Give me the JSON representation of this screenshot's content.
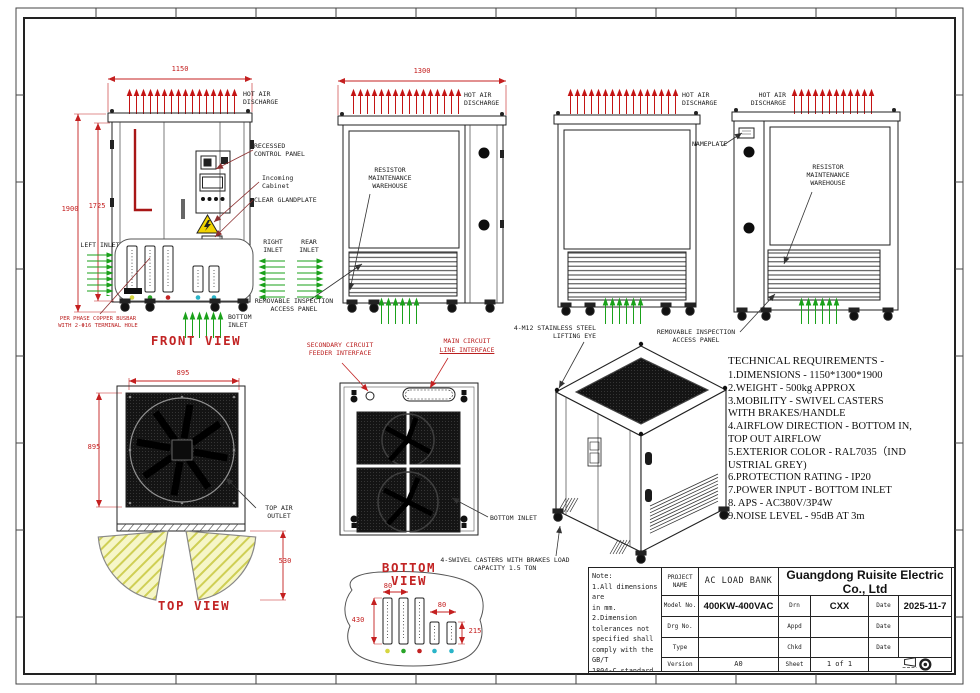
{
  "colors": {
    "dim_red": "#c42020",
    "arrow_red": "#c41414",
    "arrow_green": "#1aa11a",
    "leader_maroon": "#8b2f2f",
    "warning_yellow": "#f2d400",
    "exterior_color_code": "RAL7035"
  },
  "views": {
    "front": "FRONT VIEW",
    "top": "TOP VIEW",
    "bottom": "BOTTOM VIEW"
  },
  "dims": {
    "front_width": "1150",
    "side_width": "1300",
    "total_height": "1900",
    "body_height": "1725",
    "top_width": "895",
    "top_depth": "895",
    "door_swing": "530",
    "busbar_pitch": "80",
    "busbar_main_len": "430",
    "busbar_short_len": "215"
  },
  "labels": {
    "hot_air": "HOT AIR DISCHARGE",
    "recessed": "RECESSED CONTROL PANEL",
    "incoming": "Incoming Cabinet",
    "glandplate": "CLEAR GLANDPLATE",
    "left_inlet": "LEFT INLET",
    "right_inlet": "RIGHT INLET",
    "rear_inlet": "REAR INLET",
    "bottom_inlet": "BOTTOM INLET",
    "removable_panel": "REMOVABLE INSPECTION ACCESS PANEL",
    "busbar_note": "PER PHASE COPPER BUSBAR\nWITH 2-Φ16 TERMINAL HOLE",
    "resistor_warehouse": "RESISTOR MAINTENANCE WAREHOUSE",
    "nameplate": "NAMEPLATE",
    "secondary_feeder": "SECONDARY CIRCUIT FEEDER INTERFACE",
    "main_line1": "MAIN CIRCUIT",
    "main_line2": "LINE INTERFACE",
    "lifting_eye": "4-M12 STAINLESS STEEL LIFTING EYE",
    "swivel_casters": "4-SWIVEL CASTERS WITH BRAKES LOAD CAPACITY 1.5 TON",
    "top_air_outlet": "TOP AIR OUTLET"
  },
  "technical_requirements": {
    "title": "TECHNICAL REQUIREMENTS -",
    "lines": [
      "1.DIMENSIONS - 1150*1300*1900",
      "2.WEIGHT - 500kg APPROX",
      "3.MOBILITY - SWIVEL CASTERS",
      "WITH BRAKES/HANDLE",
      "4.AIRFLOW DIRECTION - BOTTOM IN,",
      "TOP OUT AIRFLOW",
      "5.EXTERIOR COLOR - RAL7035（IND",
      "USTRIAL GREY)",
      "6.PROTECTION RATING - IP20",
      "7.POWER INPUT - BOTTOM INLET",
      "8. APS - AC380V/3P4W",
      "9.NOISE LEVEL - 95dB AT 3m"
    ]
  },
  "title_block": {
    "note": "Note:\n1.All dimensions are\nin mm.\n2.Dimension\ntolerances not\nspecified shall\ncomply with the GB/T\n1804-C standard.",
    "project_label": "PROJECT NAME",
    "project": "AC LOAD BANK",
    "company": "Guangdong Ruisite Electric Co., Ltd",
    "model_label": "Model No.",
    "model": "400KW-400VAC",
    "drg_label": "Drg No.",
    "type_label": "Type",
    "version_label": "Version",
    "version": "A0",
    "drn_label": "Drn",
    "drn": "CXX",
    "appd_label": "Appd",
    "chkd_label": "Chkd",
    "sheet_label": "Sheet",
    "sheet": "1 of 1",
    "date_label": "Date",
    "date": "2025-11-7"
  }
}
